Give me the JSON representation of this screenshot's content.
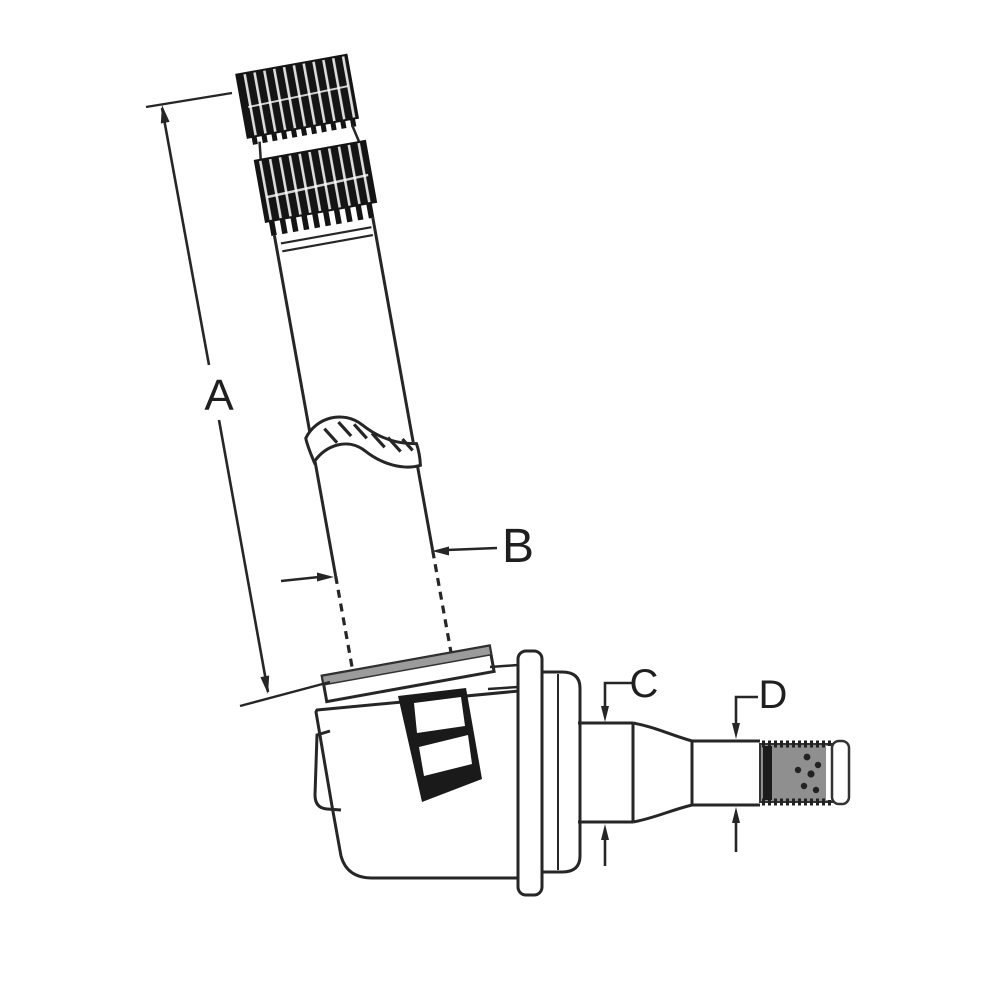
{
  "diagram": {
    "title": "spindle-technical-drawing",
    "labels": {
      "a": "A",
      "b": "B",
      "c": "C",
      "d": "D"
    },
    "colors": {
      "background": "#ffffff",
      "line": "#262626",
      "spline_fill": "#141414",
      "thread_fill": "#8f8f8f",
      "thread_dark_band": "#1b1b1b",
      "collar_fill": "#9b9b9b",
      "keyway_fill": "#1a1a1a",
      "label_color": "#1f1f1f"
    }
  }
}
